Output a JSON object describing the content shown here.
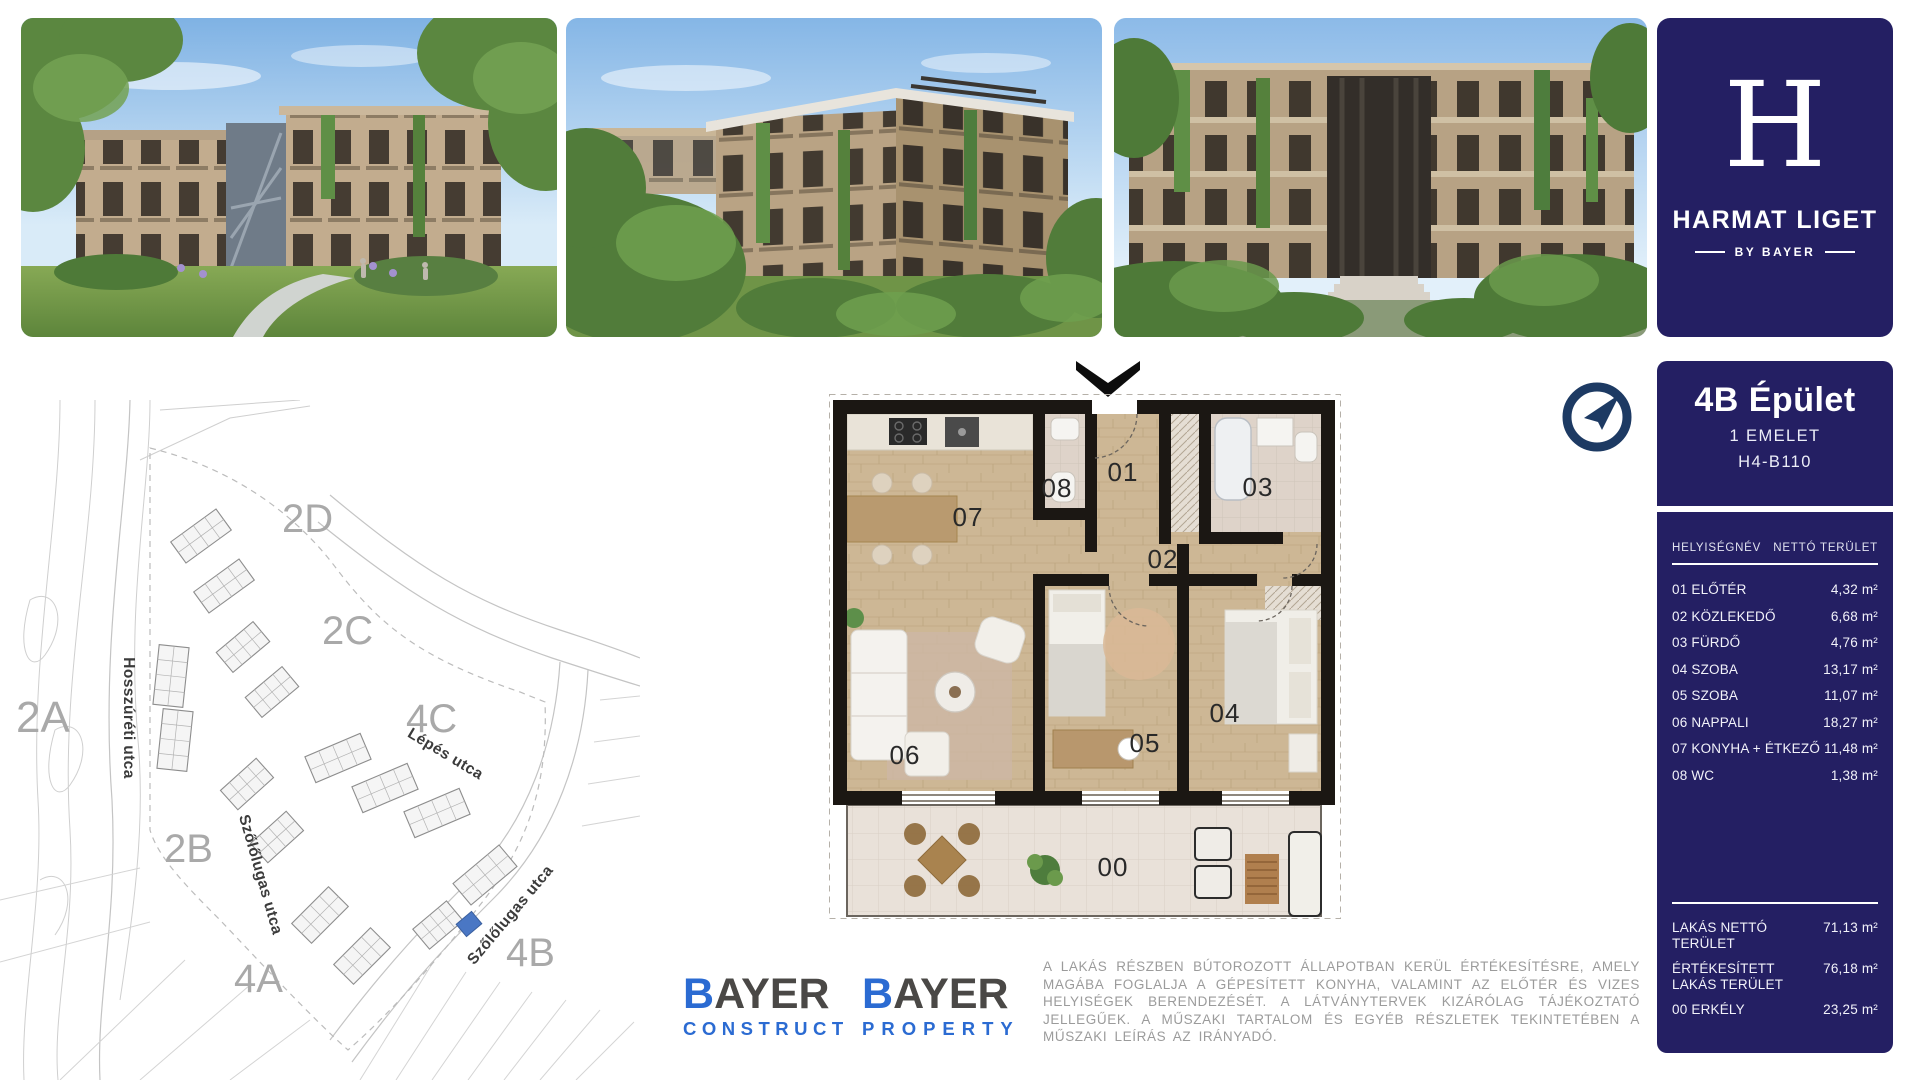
{
  "brand": {
    "logo_letter": "H",
    "logo_title": "HARMAT LIGET",
    "logo_subtitle": "BY BAYER"
  },
  "unit_panel": {
    "building": "4B Épület",
    "floor": "1 EMELET",
    "unit_id": "H4-B110",
    "table": {
      "col_room": "HELYISÉGNÉV",
      "col_area": "NETTÓ TERÜLET",
      "rows": [
        {
          "name": "01 ELŐTÉR",
          "area": "4,32 m²"
        },
        {
          "name": "02 KÖZLEKEDŐ",
          "area": "6,68 m²"
        },
        {
          "name": "03 FÜRDŐ",
          "area": "4,76 m²"
        },
        {
          "name": "04 SZOBA",
          "area": "13,17 m²"
        },
        {
          "name": "05 SZOBA",
          "area": "11,07 m²"
        },
        {
          "name": "06 NAPPALI",
          "area": "18,27 m²"
        },
        {
          "name": "07 KONYHA + ÉTKEZŐ",
          "area": "11,48 m²"
        },
        {
          "name": "08 WC",
          "area": "1,38 m²"
        }
      ]
    },
    "totals": [
      {
        "name": "LAKÁS NETTÓ TERÜLET",
        "area": "71,13 m²"
      },
      {
        "name": "ÉRTÉKESÍTETT LAKÁS TERÜLET",
        "area": "76,18 m²"
      },
      {
        "name": "00 ERKÉLY",
        "area": "23,25 m²"
      }
    ]
  },
  "site_map": {
    "building_labels": [
      "2A",
      "2B",
      "2C",
      "2D",
      "4A",
      "4B",
      "4C"
    ],
    "streets": [
      "Hosszúréti utca",
      "Lépés utca",
      "Szőlőlugas utca",
      "Szőlőlugas utca"
    ],
    "highlight_color": "#4a77c4"
  },
  "floor_plan": {
    "labels": {
      "r00": "00",
      "r01": "01",
      "r02": "02",
      "r03": "03",
      "r04": "04",
      "r05": "05",
      "r06": "06",
      "r07": "07",
      "r08": "08"
    }
  },
  "footer": {
    "logos": [
      {
        "main_first": "B",
        "main_rest": "AYER",
        "sub": "CONSTRUCT"
      },
      {
        "main_first": "B",
        "main_rest": "AYER",
        "sub": "PROPERTY"
      }
    ],
    "disclaimer": "A LAKÁS RÉSZBEN BÚTOROZOTT ÁLLAPOTBAN KERÜL ÉRTÉKESÍTÉSRE, AMELY MAGÁBA FOGLALJA A GÉPESÍTETT KONYHA, VALAMINT AZ ELŐTÉR ÉS VIZES HELYISÉGEK BERENDEZÉSÉT. A LÁTVÁNYTERVEK KIZÁRÓLAG TÁJÉKOZTATÓ JELLEGŰEK. A MŰSZAKI TARTALOM ÉS EGYÉB RÉSZLETEK TEKINTETÉBEN A MŰSZAKI LEÍRÁS AZ IRÁNYADÓ."
  },
  "colors": {
    "panel_navy": "#241f63",
    "compass_navy": "#1d3a63",
    "bayer_blue": "#2b6bd2",
    "bayer_dark": "#4a4846",
    "map_highlight": "#4a77c4",
    "disclaimer_gray": "#9b9b9b"
  }
}
